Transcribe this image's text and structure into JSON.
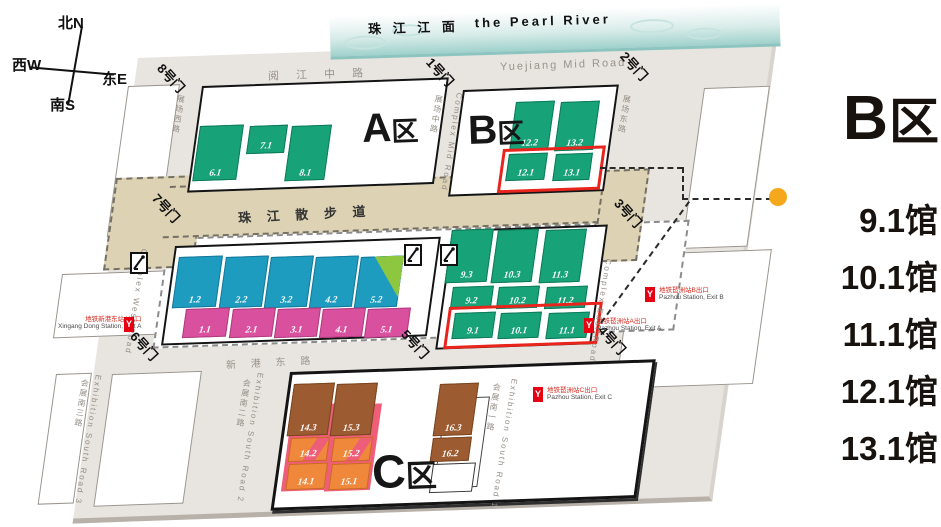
{
  "compass": {
    "north": "北N",
    "south": "南S",
    "west": "西W",
    "east": "东E"
  },
  "river": {
    "name_cn": "珠 江 江 面",
    "name_en": "the Pearl River"
  },
  "roads": {
    "yuejiang_cn": "阅 江 中 路",
    "yuejiang_en": "Yuejiang Mid Road",
    "walkway_cn": "珠 江 散 步 道",
    "xingang_cn": "新 港 东 路",
    "complex_west_cn": "展场西路",
    "complex_west_en": "Complex West Road",
    "complex_mid_cn": "展场中路",
    "complex_mid_en": "Complex Mid Road",
    "complex_east_cn": "展场东路",
    "complex_east_en": "Complex East Road",
    "south_road_1_cn": "会展南一路",
    "south_road_1_en": "Exhibition South Road 1",
    "south_road_2_cn": "会展南二路",
    "south_road_2_en": "Exhibition South Road 2",
    "south_road_3_cn": "会展南三路",
    "south_road_3_en": "Exhibition South Road 3"
  },
  "gates": [
    "1号门",
    "2号门",
    "3号门",
    "4号门",
    "5号门",
    "6号门",
    "7号门",
    "8号门"
  ],
  "areas": {
    "a": "A区",
    "b": "B区",
    "c": "C区"
  },
  "halls": {
    "a": [
      "6.1",
      "7.1",
      "8.1"
    ],
    "a2_upper": [
      "1.2",
      "2.2",
      "3.2",
      "4.2",
      "5.2"
    ],
    "a2_lower": [
      "1.1",
      "2.1",
      "3.1",
      "4.1",
      "5.1"
    ],
    "b_upper": [
      "12.2",
      "13.2",
      "12.1",
      "13.1"
    ],
    "b_lower": [
      "9.3",
      "10.3",
      "11.3",
      "9.2",
      "10.2",
      "11.2",
      "9.1",
      "10.1",
      "11.1"
    ],
    "c": [
      "14.3",
      "15.3",
      "16.3",
      "14.2",
      "15.2",
      "16.2",
      "14.1",
      "15.1"
    ]
  },
  "metro": {
    "icon_glyph": "Y",
    "xingang_a_cn": "地铁新港东站A出口",
    "xingang_a_en": "Xingang Dong Station, Exit A",
    "pazhou_a_cn": "地铁琶洲站A出口",
    "pazhou_a_en": "Pazhou Station, Exit A",
    "pazhou_b_cn": "地铁琶洲站B出口",
    "pazhou_b_en": "Pazhou Station, Exit B",
    "pazhou_c_cn": "地铁琶洲站C出口",
    "pazhou_c_en": "Pazhou Station, Exit C"
  },
  "legend": {
    "title": "B区",
    "items": [
      "9.1馆",
      "10.1馆",
      "11.1馆",
      "12.1馆",
      "13.1馆"
    ]
  },
  "colors": {
    "hall_green": "#17A278",
    "hall_blue": "#1E9CC0",
    "hall_pink": "#D9519E",
    "hall_brown": "#9C5B30",
    "hall_orange": "#F0883B",
    "plate_pink": "#EF5E78",
    "triangle_green": "#8DC63F",
    "walkway_tan": "#DDD2B4",
    "base_gray": "#E8E4DF",
    "river_teal": "#AFD8D3",
    "highlight_red": "#E8241C",
    "metro_red": "#E60012",
    "callout_orange": "#F5A81C"
  }
}
